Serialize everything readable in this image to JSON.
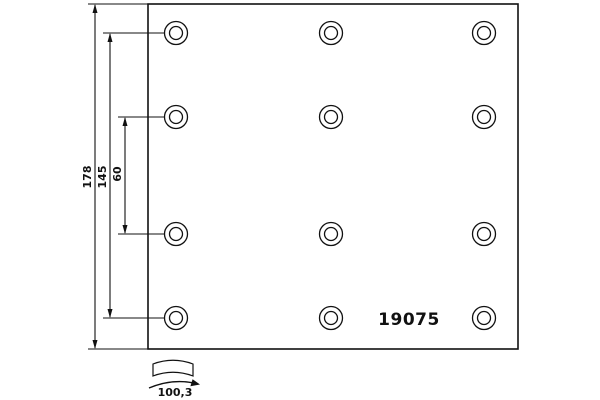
{
  "drawing": {
    "type": "brake-lining-technical-drawing",
    "part_number": "19075",
    "dimensions": {
      "total_height": "178",
      "hole_rows_span": "145",
      "middle_rows_gap": "60",
      "arc_width": "100,3"
    },
    "holes": {
      "rows": 4,
      "columns": 3,
      "total": 12,
      "style": "double-circle (countersunk rivet hole)"
    },
    "colors": {
      "line": "#111111",
      "background": "#ffffff"
    }
  }
}
